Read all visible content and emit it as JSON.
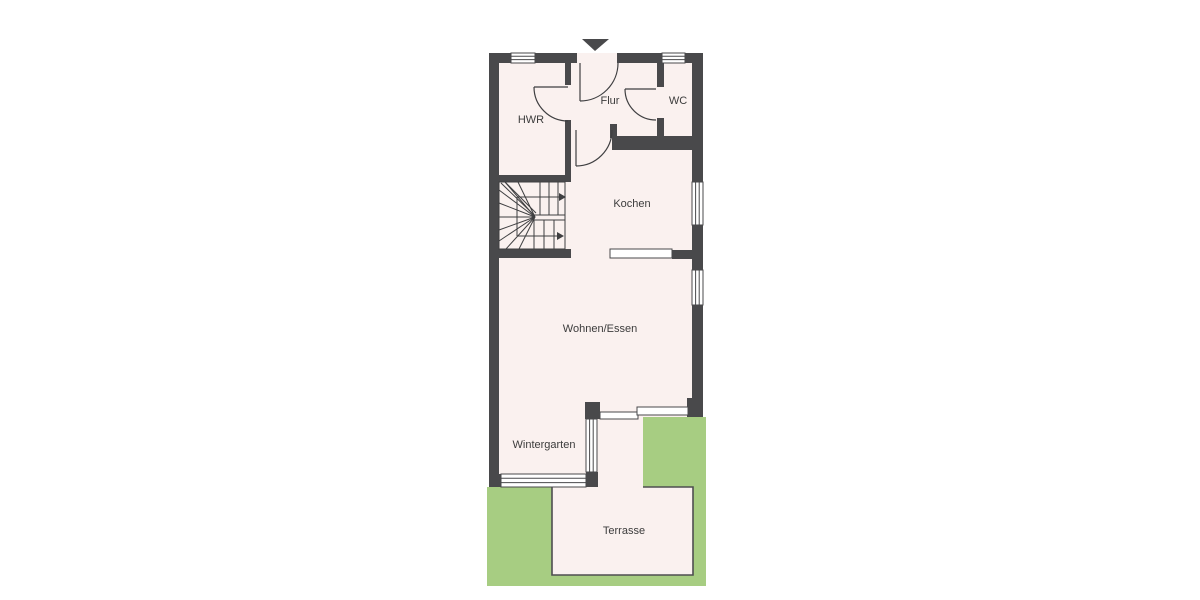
{
  "plan": {
    "type": "floorplan",
    "rooms": {
      "hwr": "HWR",
      "flur": "Flur",
      "wc": "WC",
      "kochen": "Kochen",
      "wohnen_essen": "Wohnen/Essen",
      "wintergarten": "Wintergarten",
      "terrasse": "Terrasse"
    },
    "symbols": [
      "entrance-arrow-icon",
      "door-swing-arc",
      "window-symbol",
      "sliding-door-symbol",
      "winder-stairs-symbol",
      "kitchen-counter-symbol"
    ],
    "colors": {
      "background": "#ffffff",
      "wall": "#49494b",
      "floor": "#faf1ef",
      "garden": "#a7cd82",
      "outline": "#4e4e50",
      "label": "#3c3c3c"
    }
  }
}
